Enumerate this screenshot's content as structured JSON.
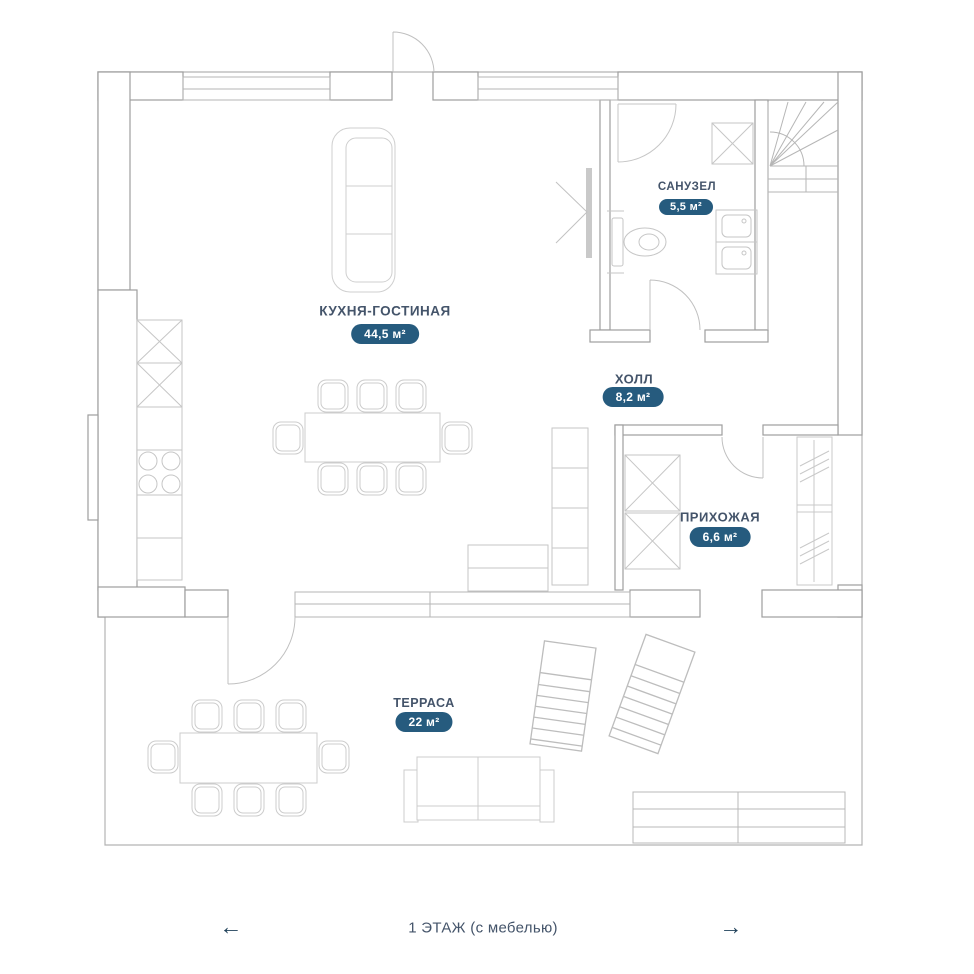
{
  "colors": {
    "accent_badge": "#265b7e",
    "label_text": "#44546a",
    "arrow": "#1f4059",
    "wall_line": "#9e9e9e",
    "furniture_line": "#c8c8c8"
  },
  "rooms": [
    {
      "name": "КУХНЯ-ГОСТИНАЯ",
      "area": "44,5 м²"
    },
    {
      "name": "САНУЗЕЛ",
      "area": "5,5 м²"
    },
    {
      "name": "ХОЛЛ",
      "area": "8,2 м²"
    },
    {
      "name": "ПРИХОЖАЯ",
      "area": "6,6 м²"
    },
    {
      "name": "ТЕРРАСА",
      "area": "22 м²"
    }
  ],
  "footer": {
    "caption": "1 ЭТАЖ (с мебелью)",
    "left_arrow": "←",
    "right_arrow": "→"
  }
}
